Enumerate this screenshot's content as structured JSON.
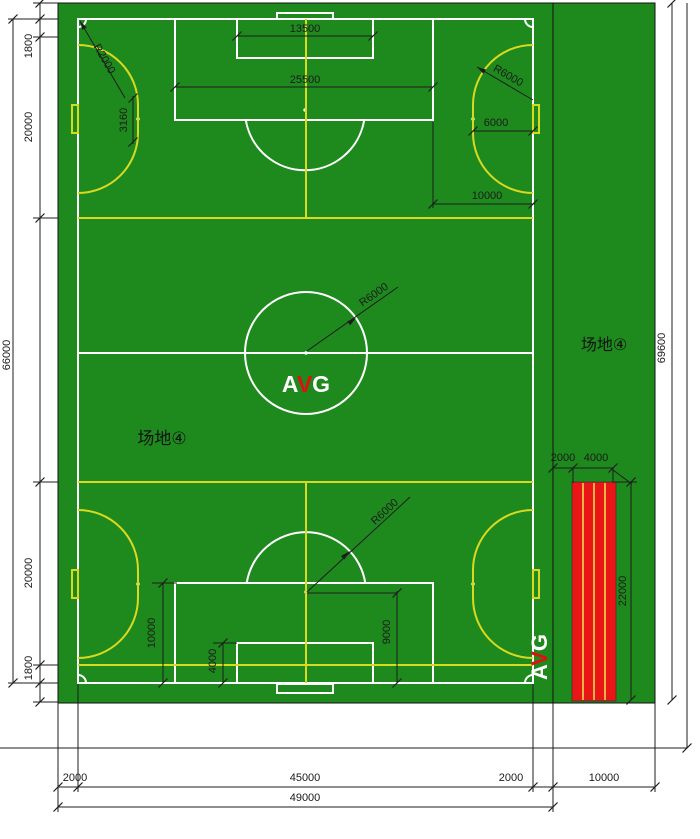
{
  "drawing_title": "场地④ 足球场平面图",
  "colors": {
    "turf_green": "#1e8a1e",
    "soccer_lines": "#ffffff",
    "futsal_lines": "#d9d920",
    "track_red": "#ea1515",
    "track_separator": "#e6e65a",
    "dimension_ink": "#1c1c1c",
    "logo_accent_red": "#e01010"
  },
  "labels": {
    "field_name_left": "场地④",
    "field_name_right": "场地④",
    "logo_a": "A",
    "logo_v": "V",
    "logo_g": "G",
    "logo_a2": "A",
    "logo_v2": "V",
    "logo_g2": "G"
  },
  "dims": {
    "left_total": "66000",
    "left_margin_top": "1800",
    "left_court_top": "20000",
    "left_court_bottom": "20000",
    "left_margin_bottom": "1800",
    "goal_area_width": "13500",
    "penalty_area_width": "25500",
    "corner_radius": "R2000",
    "futsal_arc_radius": "R6000",
    "center_circle_radius": "R6000",
    "penalty_arc_radius": "R6000",
    "arc_offset": "3160",
    "arc_to_goal_line": "6000",
    "penalty_to_touchline": "10000",
    "penalty_area_depth": "10000",
    "goal_area_depth": "4000",
    "penalty_spot_distance": "9000",
    "track_gap": "2000",
    "track_width": "4000",
    "track_length": "22000",
    "right_total": "69600",
    "bottom_margin_left": "2000",
    "bottom_field_width": "45000",
    "bottom_margin_right": "2000",
    "bottom_strip_width": "10000",
    "bottom_subtotal": "49000"
  }
}
